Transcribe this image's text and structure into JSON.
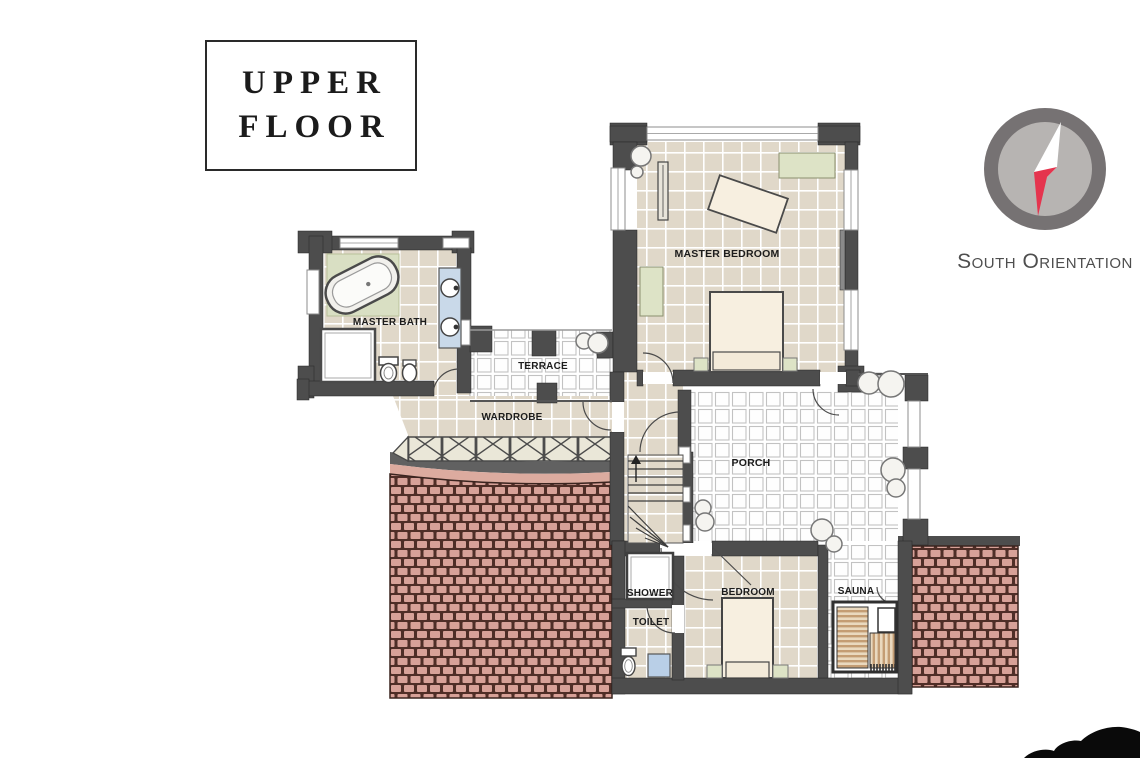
{
  "title_box": {
    "lines": [
      "UPPER",
      "FLOOR"
    ]
  },
  "compass": {
    "label": "South Orientation"
  },
  "rooms": {
    "master_bath": {
      "label": "MASTER BATH"
    },
    "terrace": {
      "label": "TERRACE"
    },
    "wardrobe": {
      "label": "WARDROBE"
    },
    "master_bedroom": {
      "label": "MASTER BEDROOM"
    },
    "porch": {
      "label": "PORCH"
    },
    "shower": {
      "label": "SHOWER"
    },
    "toilet": {
      "label": "TOILET"
    },
    "bedroom": {
      "label": "BEDROOM"
    },
    "sauna": {
      "label": "SAUNA"
    }
  },
  "colors": {
    "wall": "#4d4d4d",
    "indoor_floor": "#e0d8c9",
    "outdoor_tile": "#ffffff",
    "roof_tile": "#d7a198",
    "roof_joint": "#4f2e27",
    "furniture_green": "#dde3c6",
    "vanity_blue": "#c9d9e9",
    "railing_cream": "#eae7d8",
    "sauna_wood": "#c49d74",
    "compass_ring": "#767273",
    "compass_face": "#b7b4b2",
    "compass_needle_north": "#ffffff",
    "compass_needle_south": "#e5344e",
    "silhouette": "#0a0a0a"
  }
}
